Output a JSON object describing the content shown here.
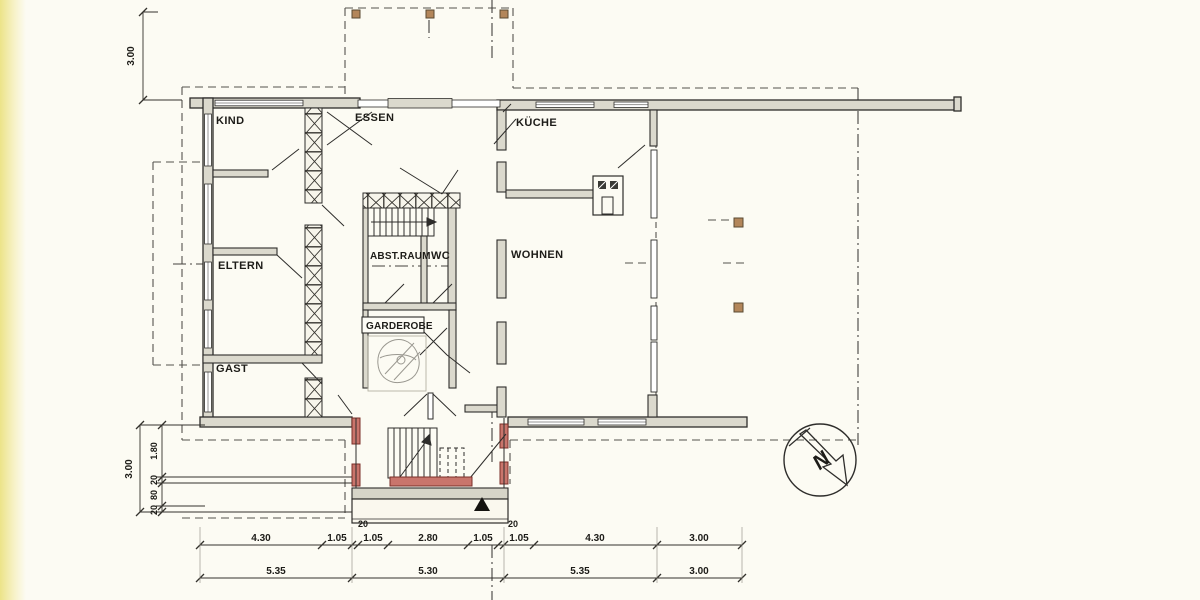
{
  "rooms": {
    "kind": "KIND",
    "essen": "ESSEN",
    "kueche": "KÜCHE",
    "eltern": "ELTERN",
    "abstellraum": "ABST.RAUM",
    "wc": "WC",
    "wohnen": "WOHNEN",
    "gast": "GAST",
    "garderobe": "GARDEROBE"
  },
  "dimensions": {
    "vertical_top": "3.00",
    "vertical_total": "3.00",
    "vertical_chain": [
      "1.80",
      "20",
      "80",
      "20"
    ],
    "row1": [
      "4.30",
      "1.05",
      "1.05",
      "2.80",
      "1.05",
      "1.05",
      "4.30",
      "3.00"
    ],
    "wall_labels": [
      "20",
      "20"
    ],
    "row2": [
      "5.35",
      "5.30",
      "5.35",
      "3.00"
    ]
  },
  "north": {
    "label": "N"
  },
  "colors": {
    "paper": "#fcfbf3",
    "line": "#2e2d2b",
    "wall_fill": "#dbd9cd",
    "accent_red": "#c9756c",
    "post_tan": "#b3865a",
    "edge_strip_yellow": "#ece388"
  }
}
